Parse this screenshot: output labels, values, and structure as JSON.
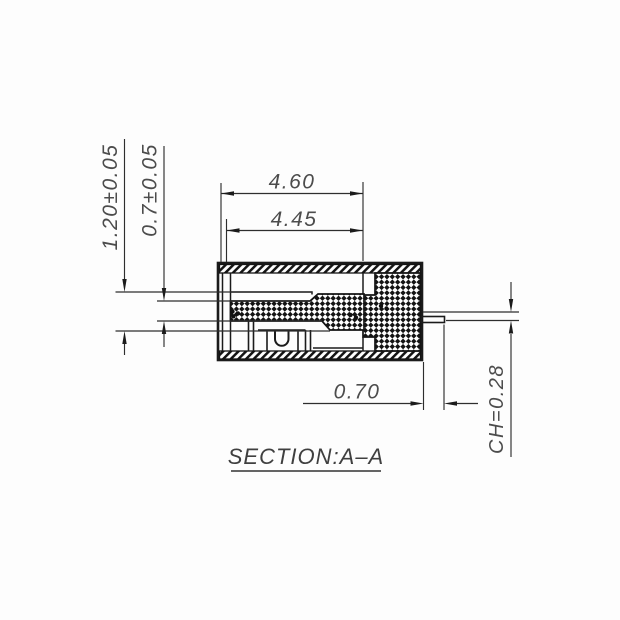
{
  "drawing": {
    "title": "SECTION:A–A",
    "view_type": "section view",
    "dimensions": {
      "outer_width": "4.60",
      "inner_width": "4.45",
      "total_height": "1.20±0.05",
      "contact_height": "0.7±0.05",
      "pin_protrusion": "0.70",
      "chamfer": "CH=0.28"
    },
    "colors": {
      "line": "#1b1b1b",
      "dimension_text": "#4c4c4c",
      "background": "#fdfdfd"
    }
  }
}
